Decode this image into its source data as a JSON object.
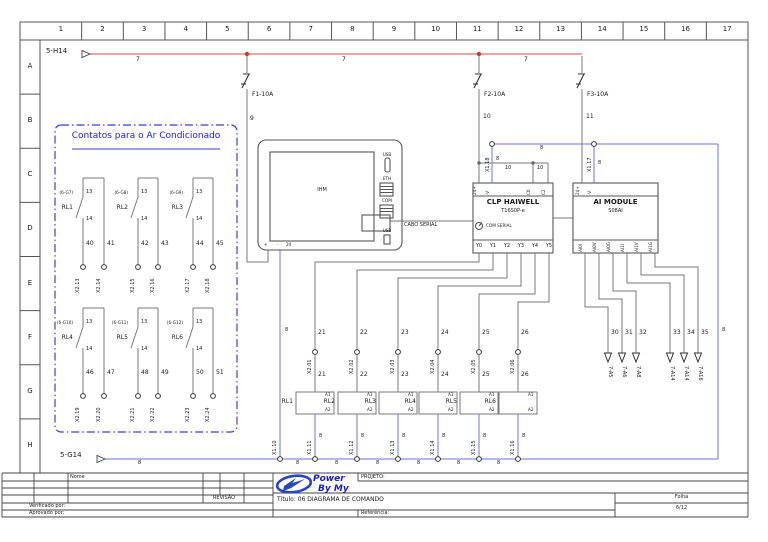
{
  "drawing": {
    "ruler_columns": [
      "1",
      "2",
      "3",
      "4",
      "5",
      "6",
      "7",
      "8",
      "9",
      "10",
      "11",
      "12",
      "13",
      "14",
      "15",
      "16",
      "17"
    ],
    "ruler_rows": [
      "A",
      "B",
      "C",
      "D",
      "E",
      "F",
      "G",
      "H"
    ],
    "source_top": {
      "tag": "5-H14"
    },
    "source_bottom": {
      "tag": "5-G14"
    },
    "wires": {
      "live": "7",
      "neutral": "8",
      "ihm_supply": "9",
      "clp_supply": "10",
      "ai_supply": "11"
    },
    "fuses": [
      {
        "id": "F1-10A"
      },
      {
        "id": "F2-10A"
      },
      {
        "id": "F3-10A"
      }
    ],
    "contacts_box": {
      "title": "Contatos para o Ar Condicionado",
      "contacts": [
        {
          "ref": "(6-G7)",
          "name": "RL1",
          "top": "13",
          "bottom": "14",
          "wire_left": "40",
          "wire_right": "41",
          "terminal_left": "X2.13",
          "terminal_right": "X2.14"
        },
        {
          "ref": "(6-G8)",
          "name": "RL2",
          "top": "13",
          "bottom": "14",
          "wire_left": "42",
          "wire_right": "43",
          "terminal_left": "X2.15",
          "terminal_right": "X2.16"
        },
        {
          "ref": "(6-G9)",
          "name": "RL3",
          "top": "13",
          "bottom": "14",
          "wire_left": "44",
          "wire_right": "45",
          "terminal_left": "X2.17",
          "terminal_right": "X2.18"
        },
        {
          "ref": "(6-G10)",
          "name": "RL4",
          "top": "13",
          "bottom": "14",
          "wire_left": "46",
          "wire_right": "47",
          "terminal_left": "X2.19",
          "terminal_right": "X2.20"
        },
        {
          "ref": "(6-G11)",
          "name": "RL5",
          "top": "13",
          "bottom": "14",
          "wire_left": "48",
          "wire_right": "49",
          "terminal_left": "X2.21",
          "terminal_right": "X2.22"
        },
        {
          "ref": "(6-G12)",
          "name": "RL6",
          "top": "13",
          "bottom": "14",
          "wire_left": "50",
          "wire_right": "51",
          "terminal_left": "X2.23",
          "terminal_right": "X2.24"
        }
      ]
    },
    "ihm": {
      "label": "IHM",
      "ports": [
        "USB",
        "ETH",
        "COM",
        "USB"
      ],
      "bottom_terminals": [
        "+",
        "-",
        "24"
      ],
      "cable": "CABO SERIAL"
    },
    "clp": {
      "name": "CLP HAIWELL",
      "model": "T16S0P-e",
      "com": "COM SERIAL",
      "top_terminals": [
        "24+",
        "-V",
        "C0",
        "C2"
      ],
      "common_wire": "10",
      "outputs": [
        "Y0",
        "Y1",
        "Y2",
        "Y3",
        "Y4",
        "Y5"
      ]
    },
    "ai": {
      "name": "AI MODULE",
      "model": "S08AI",
      "top_terminals": [
        "24+",
        "-V"
      ],
      "channels": [
        "AI0I",
        "AI0V",
        "AI0G",
        "AI1I",
        "AI1V",
        "AI1G"
      ]
    },
    "x1": {
      "left": "X1.18",
      "right": "X1.17",
      "bus": [
        "X1.10",
        "X1.11",
        "X1.12",
        "X1.13",
        "X1.14",
        "X1.15",
        "X1.16"
      ]
    },
    "relays": [
      {
        "id": "RL1",
        "wire": "21",
        "terminal": "X2.01"
      },
      {
        "id": "RL2",
        "wire": "22",
        "terminal": "X2.02"
      },
      {
        "id": "RL3",
        "wire": "23",
        "terminal": "X2.03"
      },
      {
        "id": "RL4",
        "wire": "24",
        "terminal": "X2.04"
      },
      {
        "id": "RL5",
        "wire": "25",
        "terminal": "X2.05"
      },
      {
        "id": "RL6",
        "wire": "26",
        "terminal": "X2.06"
      }
    ],
    "coil": {
      "a1": "A1",
      "a2": "A2"
    },
    "analog_dests": [
      {
        "wire": "30",
        "dest": "7-A5"
      },
      {
        "wire": "31",
        "dest": "7-A6"
      },
      {
        "wire": "32",
        "dest": "7-A8"
      },
      {
        "wire": "33",
        "dest": "7-A14"
      },
      {
        "wire": "34",
        "dest": "7-A14"
      },
      {
        "wire": "35",
        "dest": "7-A16"
      }
    ]
  },
  "title_block": {
    "nome": "Nome",
    "revisao": "REVISÃO",
    "verificado": "Verificado por:",
    "aprovado": "Aprovado por:",
    "logo_top": "Power",
    "logo_bottom": "By My",
    "projeto": "PROJETO:",
    "titulo": "Título: 06 DIAGRAMA DE COMANDO",
    "referencia": "Referência:",
    "folha_label": "Folha",
    "folha": "6/12"
  },
  "colors": {
    "live": "#e86b6b",
    "neutral": "#8a8ae8",
    "signal": "#7a7a7a",
    "accent": "#1c1ccf",
    "logo": "#2746c4"
  }
}
